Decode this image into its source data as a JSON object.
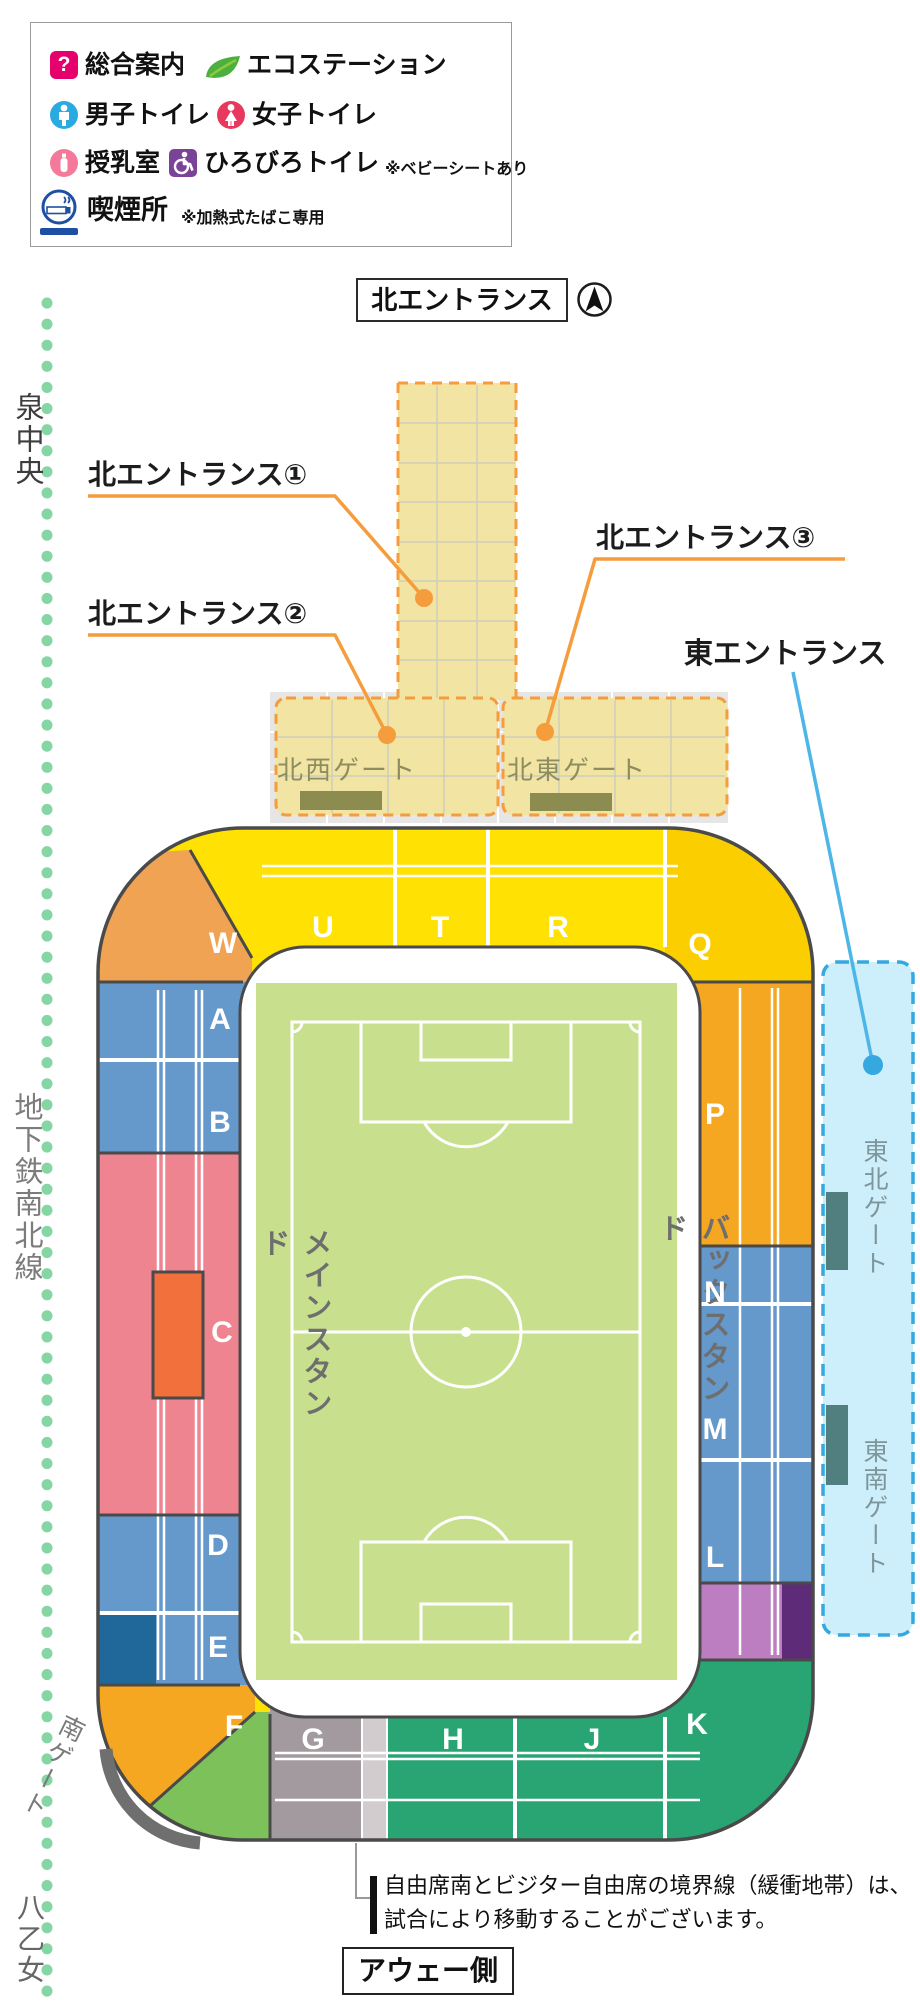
{
  "colors": {
    "band_yellow": "#FFE104",
    "corner_gold": "#FBCE00",
    "corner_orange_w": "#EFA353",
    "band_orange": "#F6A722",
    "band_blue": "#6598CB",
    "band_dark_blue": "#20689A",
    "band_pink": "#EE8490",
    "vip_orange": "#F1703C",
    "band_teal": "#29A573",
    "corner_light_green": "#7CC159",
    "band_gray": "#A29A9E",
    "buffer_stripe": "#D2CCCE",
    "purple_light": "#BC7EC0",
    "purple_dark": "#5D2B78",
    "field_green": "#C8E08E",
    "outline": "#4A4A4A",
    "corridor_fill": "#F2E5A3",
    "corridor_dash": "#F59C3C",
    "plaza_gray": "#E6E6E6",
    "gate_bar_olive": "#8C8B50",
    "cyan_fill": "#CCEFFB",
    "cyan_dash": "#35A8E0",
    "cyan_bar": "#517F80",
    "rail_dot": "#86D6A5",
    "south_gate_arc": "#6F6F6F"
  },
  "legend": {
    "items": [
      {
        "icon": "question-icon",
        "glyph": "?",
        "label": "総合案内"
      },
      {
        "icon": "leaf-icon",
        "label": "エコステーション"
      },
      {
        "icon": "male-icon",
        "label": "男子トイレ"
      },
      {
        "icon": "female-icon",
        "label": "女子トイレ"
      },
      {
        "icon": "nursing-icon",
        "label": "授乳室"
      },
      {
        "icon": "wheelchair-icon",
        "label": "ひろびろトイレ",
        "note": "※ベビーシートあり"
      },
      {
        "icon": "smoking-icon",
        "label": "喫煙所",
        "note": "※加熱式たばこ専用"
      }
    ]
  },
  "north_header": {
    "title": "北エントランス"
  },
  "entrances": {
    "n1": "北エントランス①",
    "n2": "北エントランス②",
    "n3": "北エントランス③",
    "east": "東エントランス"
  },
  "gates": {
    "northwest": "北西ゲート",
    "northeast": "北東ゲート",
    "east_north": "東北ゲート",
    "east_south": "東南ゲート",
    "south": "南ゲート"
  },
  "railway": {
    "station_top": "泉中央",
    "line_name": "地下鉄南北線",
    "station_bottom": "八乙女"
  },
  "stands": {
    "main": "メインスタンド",
    "back": "バックスタンド"
  },
  "sections": {
    "W": "W",
    "U": "U",
    "T": "T",
    "R": "R",
    "Q": "Q",
    "P": "P",
    "A": "A",
    "B": "B",
    "C": "C",
    "D": "D",
    "E": "E",
    "F": "F",
    "G": "G",
    "H": "H",
    "J": "J",
    "K": "K",
    "N": "N",
    "M": "M",
    "L": "L"
  },
  "footer": {
    "note_line1": "自由席南とビジター自由席の境界線（緩衝地帯）は、",
    "note_line2": "試合により移動することがございます。",
    "away_side": "アウェー側"
  }
}
